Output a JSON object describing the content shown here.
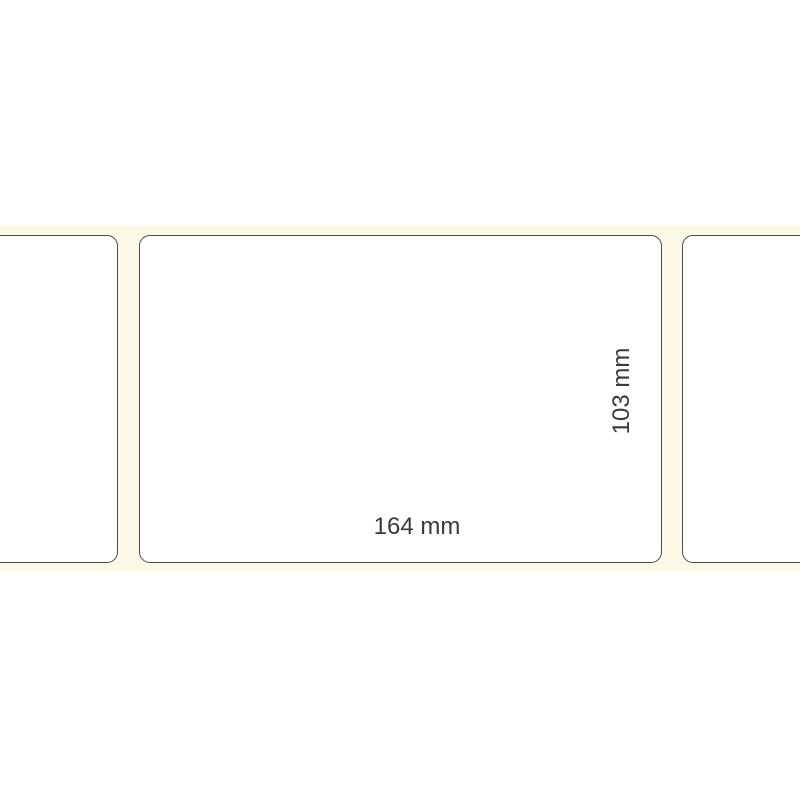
{
  "scene": {
    "description": "Blank rectangular adhesive labels on carrier liner with dimension annotations",
    "dimensions": {
      "width_label": "164 mm",
      "height_label": "103 mm"
    },
    "colors": {
      "background": "#ffffff",
      "liner": "#fcf9e6",
      "label_fill": "#ffffff",
      "label_border": "#4a4a4a",
      "dimension_text": "#3a3a3a"
    }
  }
}
